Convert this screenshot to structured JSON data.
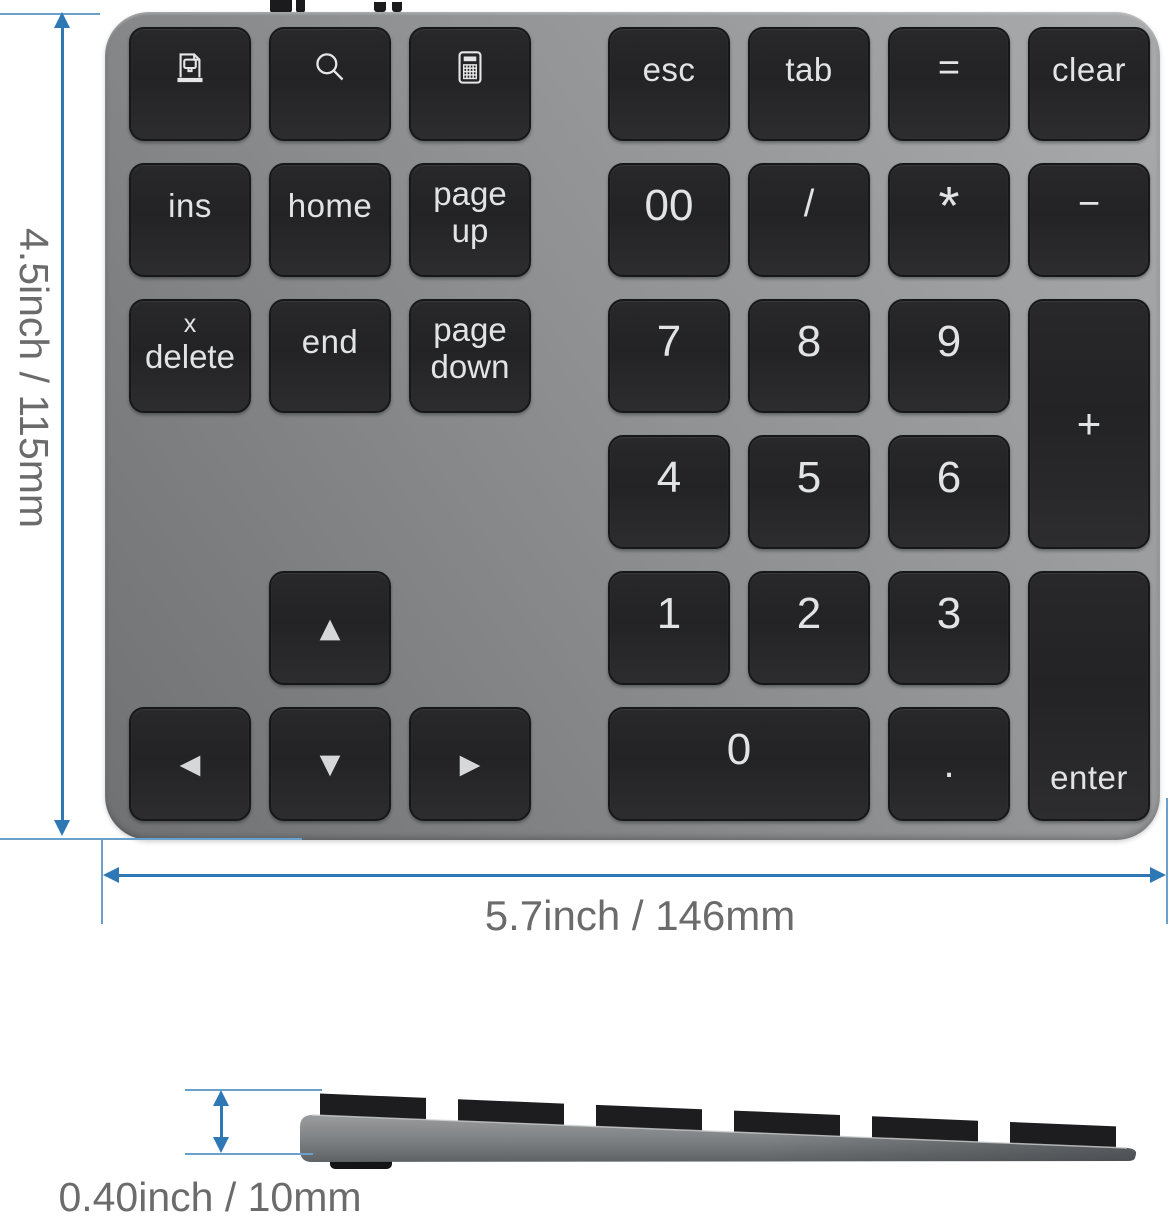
{
  "dimension_labels": {
    "height": "4.5inch / 115mm",
    "width": "5.7inch / 146mm",
    "thickness": "0.40inch / 10mm"
  },
  "colors": {
    "dimension_blue": "#2e79b5",
    "dimension_text": "#6b6b6b",
    "keypad_body_gray": "#8f9193",
    "key_black": "#252527",
    "key_text": "#e2e3e4",
    "background": "#ffffff"
  },
  "keypad": {
    "icons": {
      "screen": "screen-print-icon",
      "search": "search-icon",
      "calc": "calculator-icon",
      "arrows": [
        "arrow-up-icon",
        "arrow-left-icon",
        "arrow-down-icon",
        "arrow-right-icon"
      ]
    },
    "keys": {
      "esc": "esc",
      "tab": "tab",
      "equals": "=",
      "clear": "clear",
      "ins": "ins",
      "home": "home",
      "page_up": {
        "line1": "page",
        "line2": "up"
      },
      "double_zero": "00",
      "divide": "/",
      "multiply": "*",
      "minus": "−",
      "delete": {
        "line1": "x",
        "line2": "delete"
      },
      "end": "end",
      "page_down": {
        "line1": "page",
        "line2": "down"
      },
      "seven": "7",
      "eight": "8",
      "nine": "9",
      "plus": "+",
      "four": "4",
      "five": "5",
      "six": "6",
      "one": "1",
      "two": "2",
      "three": "3",
      "zero": "0",
      "decimal": ".",
      "enter": "enter",
      "arrow_up": "▲",
      "arrow_left": "◀",
      "arrow_down": "▼",
      "arrow_right": "▶"
    }
  }
}
